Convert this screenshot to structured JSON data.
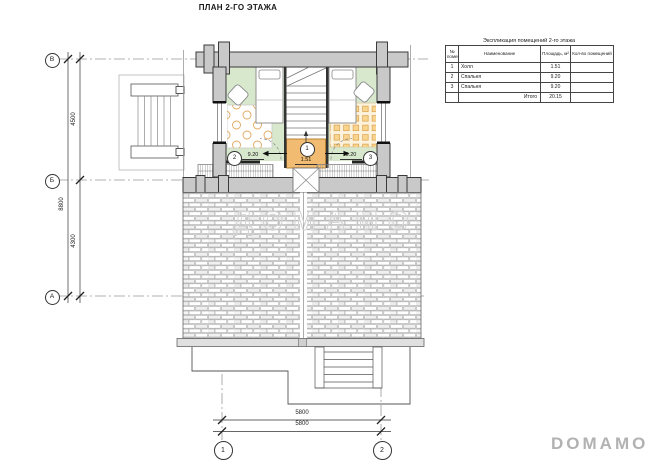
{
  "page": {
    "title": "ПЛАН 2-ГО ЭТАЖА"
  },
  "watermark": {
    "text": "ДОМАМО"
  },
  "brand": {
    "logo": "DOMAMO"
  },
  "axes": {
    "row_top": "В",
    "row_mid": "Б",
    "row_bottom": "А",
    "col_left": "1",
    "col_right": "2"
  },
  "dimensions": {
    "left_upper": "4500",
    "left_total": "8800",
    "left_lower": "4300",
    "bottom_outer": "5800",
    "bottom_inner": "5800"
  },
  "rooms": {
    "hall": {
      "num": "1",
      "area": "1.51"
    },
    "bedroom_left": {
      "num": "2",
      "area": "9.20"
    },
    "bedroom_right": {
      "num": "3",
      "area": "9.20"
    }
  },
  "legend_table": {
    "title": "Экспликация помещений 2-го этажа",
    "headers": {
      "num": "№ помещения",
      "name": "Наименование",
      "area": "Площадь, м²",
      "count": "Кол-во помещений"
    },
    "rows": [
      {
        "num": "1",
        "name": "Холл",
        "area": "1.51",
        "count": ""
      },
      {
        "num": "2",
        "name": "Спальня",
        "area": "9.20",
        "count": ""
      },
      {
        "num": "3",
        "name": "Спальня",
        "area": "9.20",
        "count": ""
      }
    ],
    "total_label": "Итого",
    "total_value": "20.15"
  }
}
